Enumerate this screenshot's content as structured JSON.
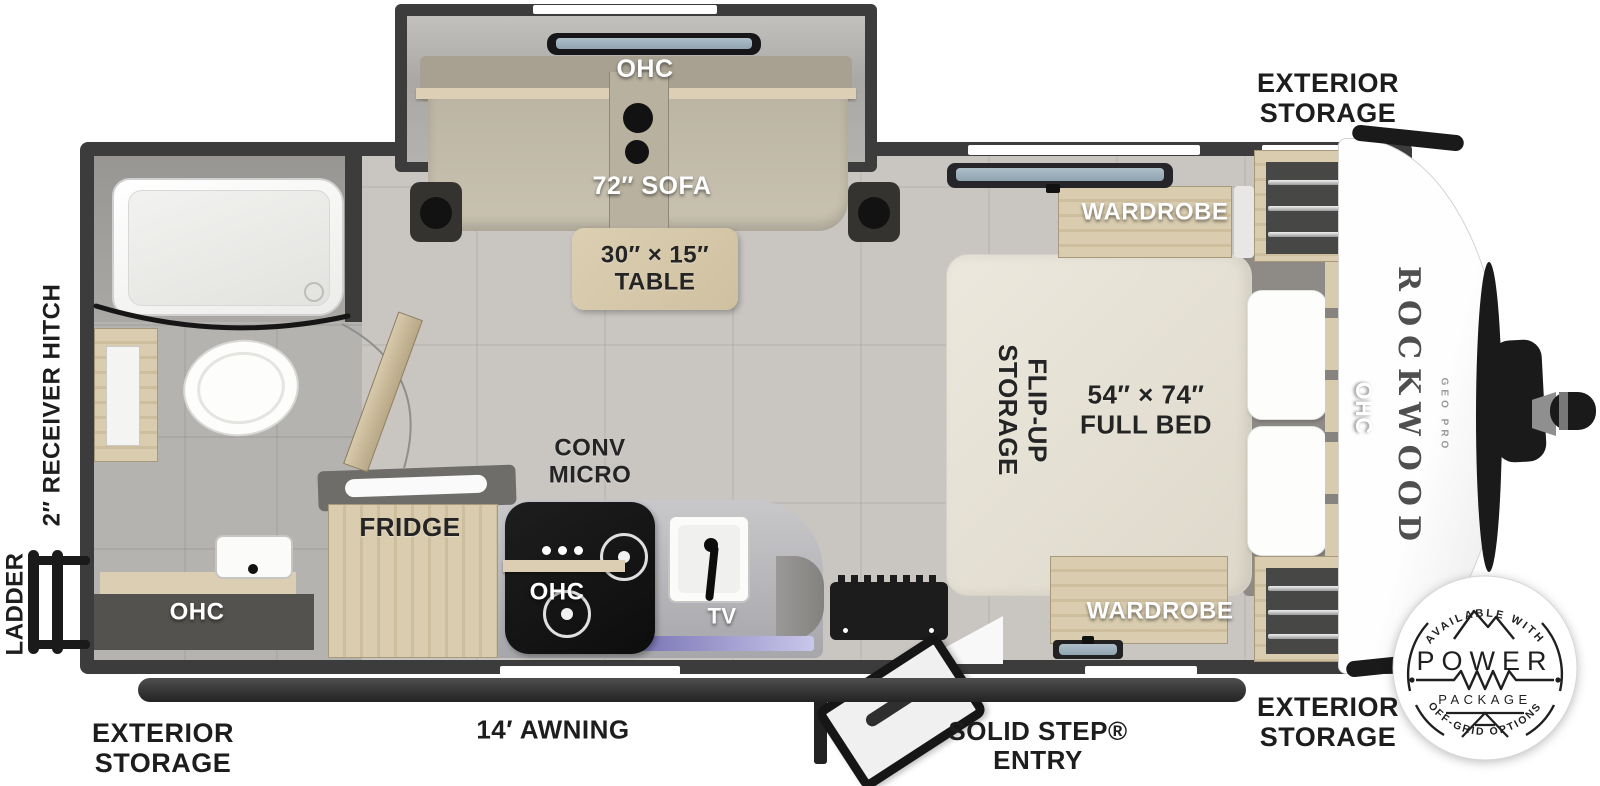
{
  "exterior": {
    "storage_top": "EXTERIOR\nSTORAGE",
    "storage_bottom_right": "EXTERIOR\nSTORAGE",
    "storage_bottom_left": "EXTERIOR\nSTORAGE",
    "awning": "14′ AWNING",
    "solid_step": "SOLID STEP®\nENTRY",
    "ladder": "LADDER",
    "receiver_hitch": "2″ RECEIVER HITCH"
  },
  "slideout": {
    "ohc": "OHC",
    "sofa": "72″ SOFA",
    "table": "30″ × 15″\nTABLE"
  },
  "kitchen": {
    "fridge": "FRIDGE",
    "conv_micro": "CONV\nMICRO",
    "ohc": "OHC",
    "tv": "TV"
  },
  "bathroom": {
    "ohc": "OHC"
  },
  "bedroom": {
    "wardrobe_top": "WARDROBE",
    "wardrobe_bottom": "WARDROBE",
    "flip_up_storage": "FLIP-UP\nSTORAGE",
    "bed": "54″ × 74″\nFULL BED",
    "ohc": "OHC"
  },
  "brand": {
    "name": "ROCKWOOD",
    "model": "GEO PRO"
  },
  "badge": {
    "available": "AVAILABLE WITH",
    "power": "POWER",
    "package": "PACKAGE",
    "offgrid": "OFF-GRID OPTIONS"
  },
  "colors": {
    "wall": "#3c3c3c",
    "floor": "#c9c6c2",
    "wood": "#d5c8ab",
    "sofa": "#c4bdac",
    "bed": "#e7e3d8",
    "accent_black": "#1b1b1b",
    "label_light": "#ffffff",
    "label_dark": "#1f1f1f"
  }
}
